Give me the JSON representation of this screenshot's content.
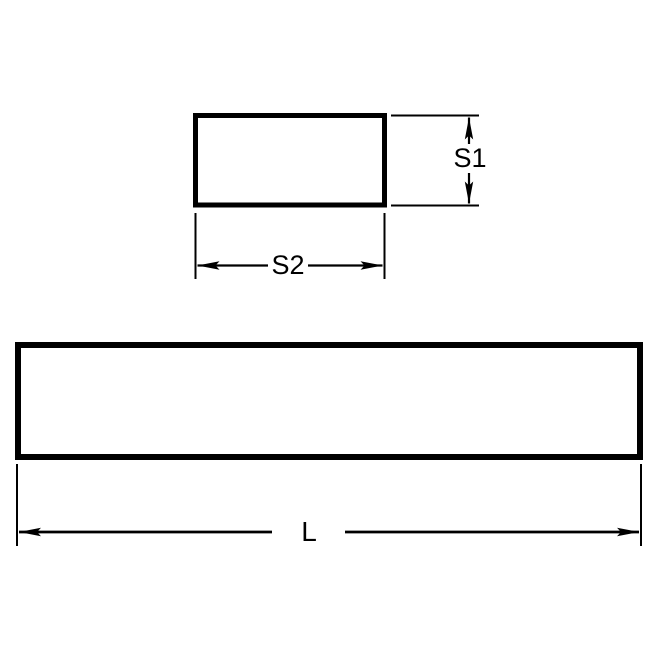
{
  "diagram": {
    "title": "rectangular-keystock-dimension-drawing",
    "colors": {
      "line": "#000000",
      "background": "#ffffff"
    },
    "views": {
      "cross_section": {
        "shape": "rectangle"
      },
      "side_view": {
        "shape": "rectangle"
      }
    },
    "labels": {
      "s1": "S1",
      "s2": "S2",
      "length": "L"
    }
  }
}
